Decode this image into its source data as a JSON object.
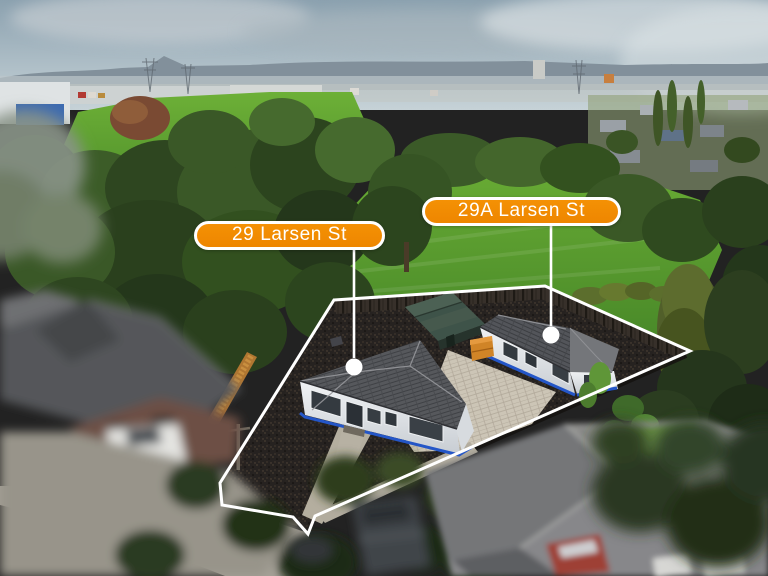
{
  "annotations": {
    "front_label": {
      "text": "29 Larsen St"
    },
    "rear_label": {
      "text": "29A Larsen St"
    },
    "label_background_color": "#f18b00",
    "label_border_color": "#ffffff",
    "boundary_line_color": "#ffffff",
    "house_trim_color": "#2456c8"
  }
}
